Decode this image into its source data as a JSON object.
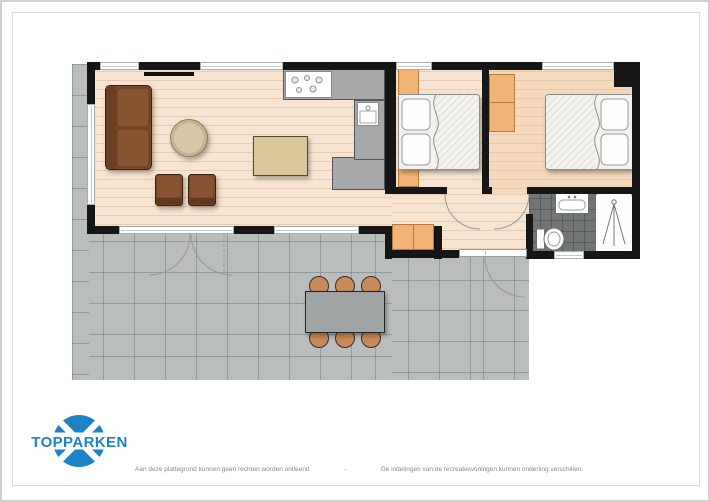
{
  "brand": {
    "name": "TOPPARKEN"
  },
  "footer": {
    "left": "Aan deze plattegrond kunnen geen rechten worden ontleend",
    "sep": "-",
    "right": "De indelingen van de recreatiewoningen kunnen onderling verschillen."
  },
  "colors": {
    "brand_blue": "#1d83c4",
    "wall_black": "#161616",
    "wood_floor": "#f7e4d0",
    "terrace_tile": "#b9bdbc",
    "bathroom_tile": "#717576",
    "cabinet_orange": "#f2b376",
    "counter_gray": "#a6a8aa",
    "sofa_brown": "#7a4c2b",
    "outdoor_chair_tan": "#c78a58"
  }
}
